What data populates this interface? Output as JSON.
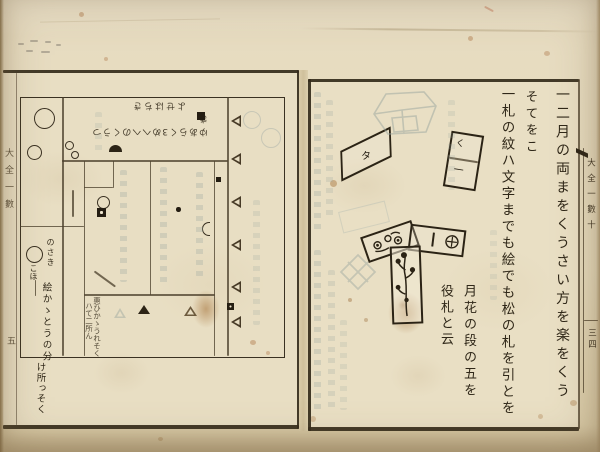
{
  "left_page": {
    "hashira_title": "大全一數",
    "page_number": "五",
    "diagram": {
      "top_label_line1": "ゆあらく3めへへのくうつき",
      "top_label_line2": "よせはちき",
      "corner_note_head": "のさき",
      "corner_note_head2": "こほ",
      "corner_note_col1": "絵かゝとうの分",
      "corner_note_col2": "け所っそく",
      "box_note_col1": "惠ひかゝうれそく",
      "box_note_col2": "ハて二所ん"
    }
  },
  "right_page": {
    "text_columns": [
      {
        "text": "一二月の両まをくうさい方を楽をくう"
      },
      {
        "text": "そてをこ"
      },
      {
        "text": "一札の紋ハ文字までも絵でも松の札を引とを"
      },
      {
        "text": "月花の段の五を"
      },
      {
        "text": "役札と云"
      }
    ],
    "cards": {
      "tilted_card_label": "タ",
      "split_card_top": "く",
      "split_card_bottom": "一"
    },
    "edge_strip": {
      "title": "大全一數十",
      "page_number": "三四"
    }
  }
}
